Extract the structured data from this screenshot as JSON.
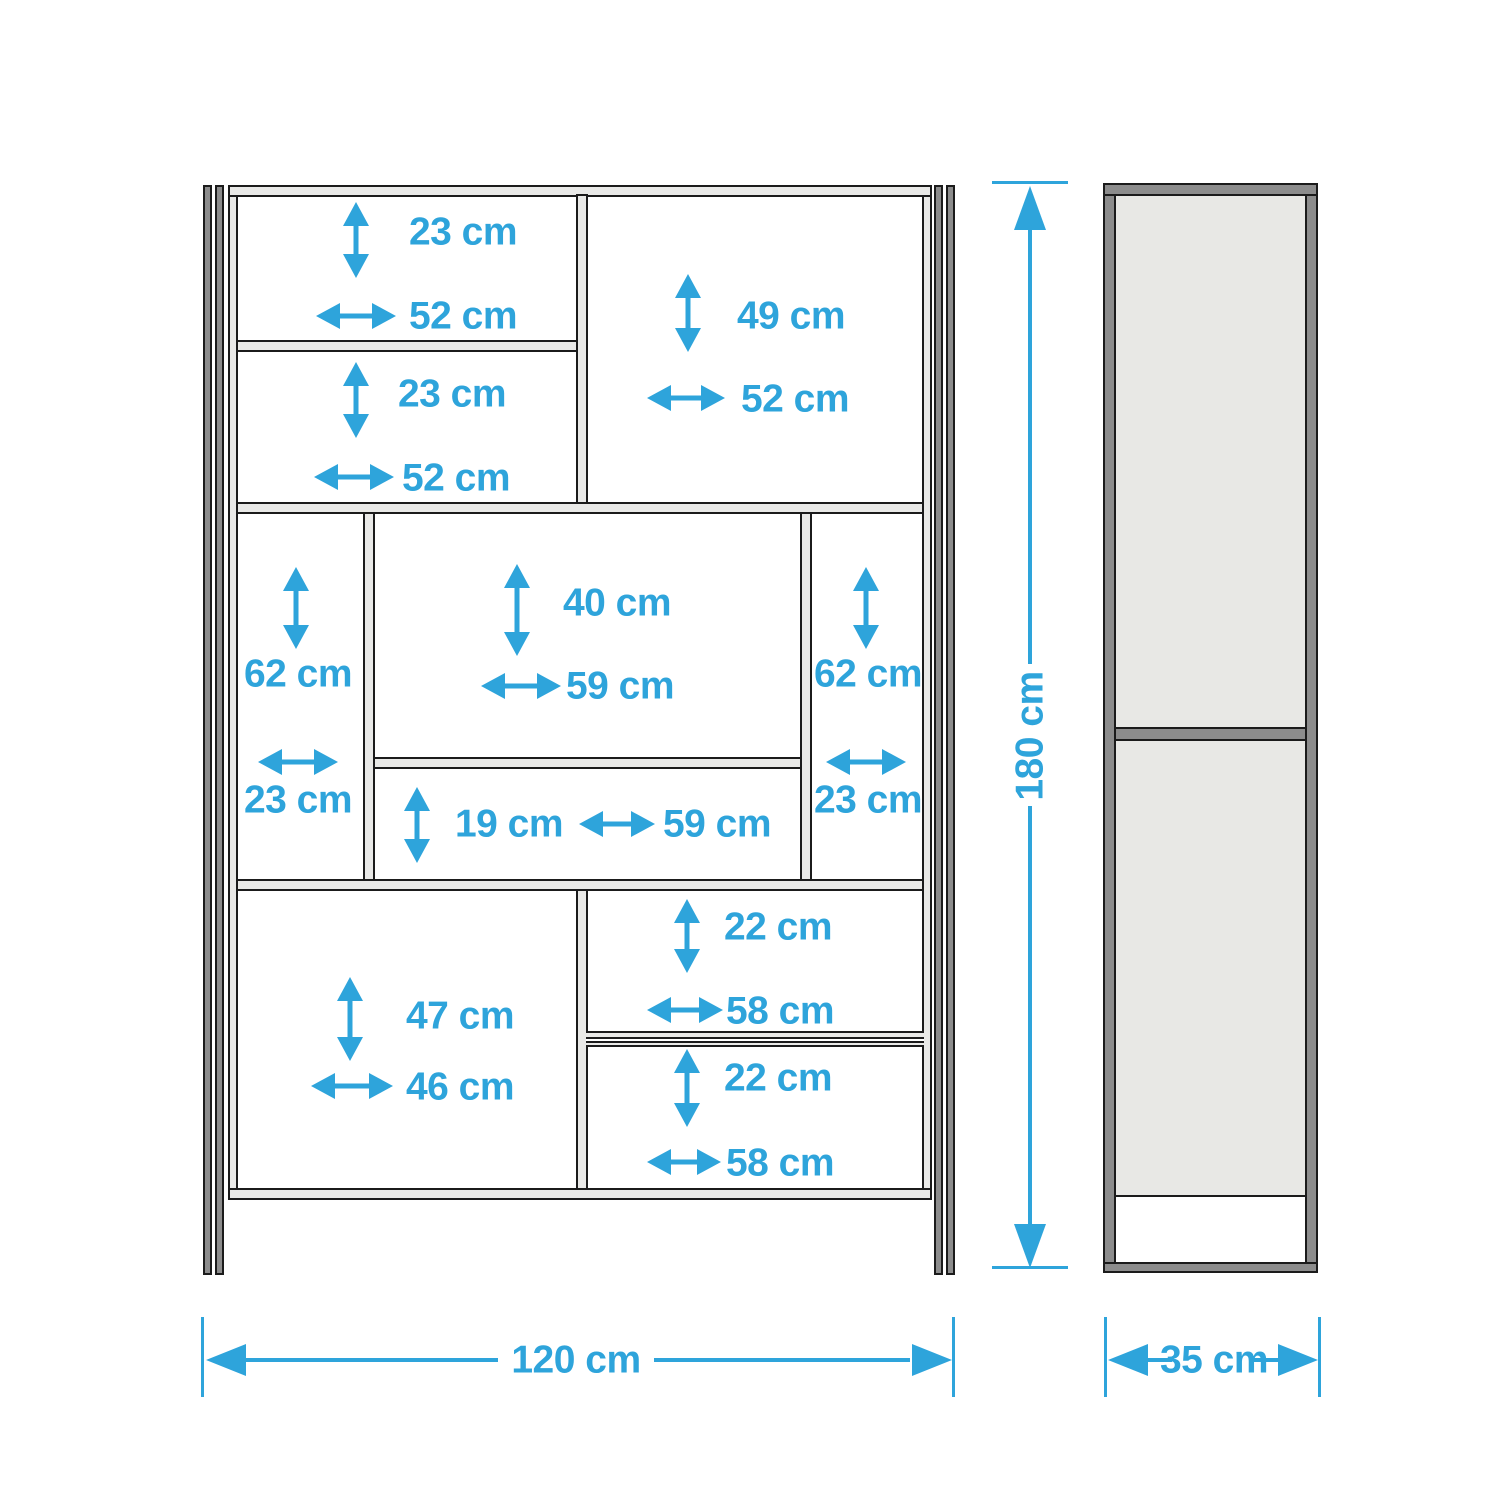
{
  "front_view": {
    "compartments": [
      {
        "id": "top-left-upper",
        "height": "23 cm",
        "width": "52 cm"
      },
      {
        "id": "top-left-lower",
        "height": "23 cm",
        "width": "52 cm"
      },
      {
        "id": "top-right",
        "height": "49 cm",
        "width": "52 cm"
      },
      {
        "id": "middle-left",
        "height": "62 cm",
        "width": "23 cm"
      },
      {
        "id": "middle-center-upper",
        "height": "40 cm",
        "width": "59 cm"
      },
      {
        "id": "middle-center-lower",
        "height": "19 cm",
        "width": "59 cm"
      },
      {
        "id": "middle-right",
        "height": "62 cm",
        "width": "23 cm"
      },
      {
        "id": "bottom-left",
        "height": "47 cm",
        "width": "46 cm"
      },
      {
        "id": "bottom-right-upper",
        "height": "22 cm",
        "width": "58 cm"
      },
      {
        "id": "bottom-right-lower",
        "height": "22 cm",
        "width": "58 cm"
      }
    ]
  },
  "dimensions": {
    "overall_width": "120 cm",
    "overall_height": "180 cm",
    "overall_depth": "35 cm"
  },
  "colors": {
    "dimension_blue": "#2ea4db",
    "frame_gray": "#8c8c8c",
    "panel_light_gray": "#e9e9e7",
    "outline": "#1b1b1b"
  }
}
